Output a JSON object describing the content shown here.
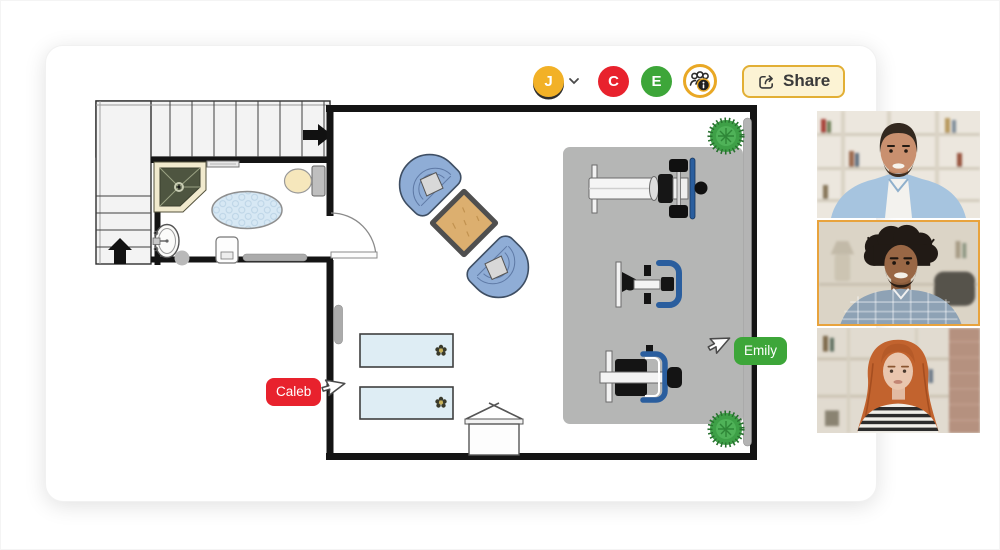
{
  "collaboration": {
    "current_user": {
      "initial": "J",
      "color": "#F2B127",
      "has_dropdown": true
    },
    "collaborators": [
      {
        "initial": "C",
        "color": "#E8222D"
      },
      {
        "initial": "E",
        "color": "#3DA639"
      }
    ],
    "people_info_icon": "collaborators-info-icon",
    "share_button": {
      "label": "Share",
      "background": "#FCF3D4",
      "border": "#E2AF35",
      "text_color": "#3A3A3A"
    }
  },
  "cursors": [
    {
      "label": "Caleb",
      "color": "#E8222D"
    },
    {
      "label": "Emily",
      "color": "#3DA639"
    }
  ],
  "floor_plan": {
    "rooms": [
      "staircase",
      "bathroom",
      "main-room",
      "gym-area"
    ],
    "objects": [
      "stairs-up-arrow",
      "stairs-right-arrow",
      "corner-shower",
      "toilet",
      "sink",
      "oval-rug",
      "towel-rail",
      "waste-bin",
      "door-swing",
      "bathroom-radiator",
      "wall-radiator",
      "wall-rail",
      "armchair-left",
      "armchair-right",
      "square-coffee-table",
      "gym-mat",
      "bench-press",
      "exercise-bike",
      "rowing-machine",
      "massage-table-1",
      "massage-table-2",
      "flower-decor",
      "laundry-basket",
      "potted-plant-top",
      "potted-plant-bottom"
    ],
    "colors": {
      "wall": "#141414",
      "mat": "#B5B6B5",
      "armchair": "#8FADD6",
      "table_wood": "#DCAF6F",
      "plant": "#3EA047",
      "rug": "#D7E8F4",
      "massage_table": "#DEEDF4",
      "equipment_accent": "#2A5E9E"
    }
  },
  "video_call": {
    "participants": [
      {
        "id": "participant-1",
        "active": false
      },
      {
        "id": "participant-2",
        "active": true,
        "highlight_color": "#E8A33D"
      },
      {
        "id": "participant-3",
        "active": false
      }
    ]
  }
}
